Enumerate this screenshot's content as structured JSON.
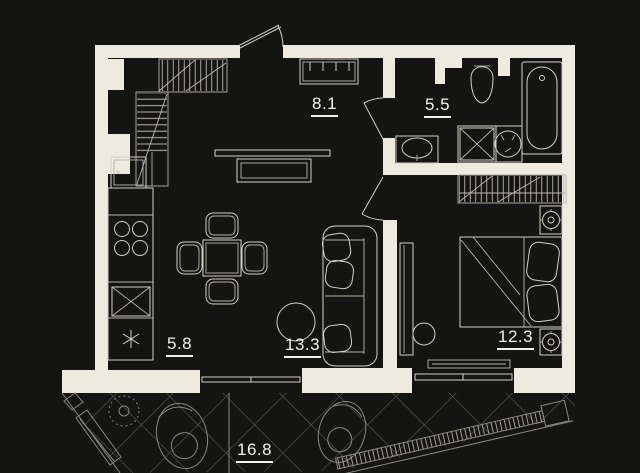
{
  "floor_plan": {
    "rooms": [
      {
        "name": "hallway",
        "area_label": "8.1"
      },
      {
        "name": "bathroom",
        "area_label": "5.5"
      },
      {
        "name": "kitchen",
        "area_label": "5.8"
      },
      {
        "name": "living-room",
        "area_label": "13.3"
      },
      {
        "name": "bedroom",
        "area_label": "12.3"
      },
      {
        "name": "terrace",
        "area_label": "16.8"
      }
    ],
    "colors": {
      "background": "#141413",
      "walls": "#efeade",
      "furniture_lines": "#d3cfc5",
      "terrace_hatch": "#5d5950",
      "label_text": "#f4f1ea"
    }
  }
}
